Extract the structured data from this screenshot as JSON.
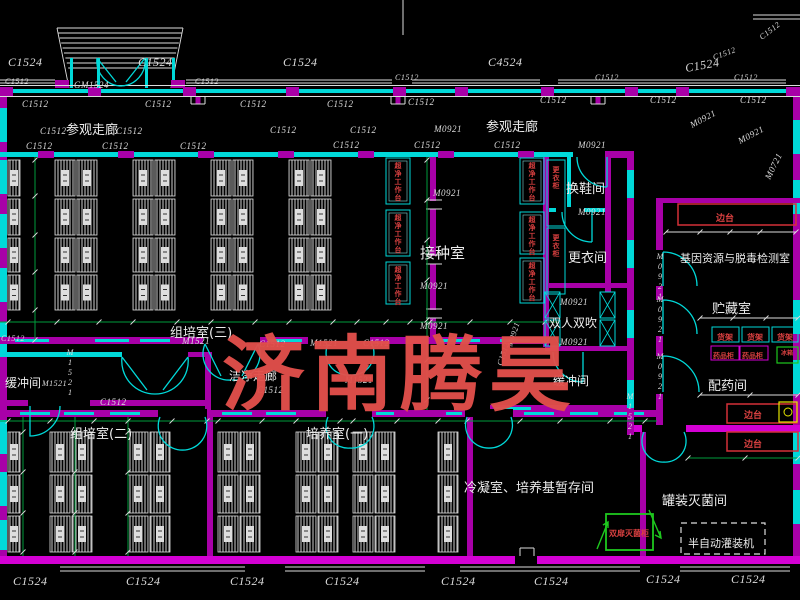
{
  "drawing": {
    "watermark": "济南腾昊",
    "colors": {
      "background": "#000000",
      "wall_cyan": "#00d9d9",
      "wall_magenta": "#a800a8",
      "wall_magenta_bright": "#d400d4",
      "line_white": "#dcdcdc",
      "dim_green": "#009c3c",
      "equip_red": "#d43038",
      "equip_green": "#1ec81e",
      "yellow": "#e6e600",
      "watermark_red": "#e2504b"
    },
    "labels": [
      {
        "t": "C1524",
        "x": 8,
        "y": 66,
        "s": 12,
        "k": "code"
      },
      {
        "t": "C1524",
        "x": 138,
        "y": 66,
        "s": 12,
        "k": "code"
      },
      {
        "t": "C1524",
        "x": 283,
        "y": 66,
        "s": 12,
        "k": "code"
      },
      {
        "t": "C4524",
        "x": 488,
        "y": 66,
        "s": 12,
        "k": "code"
      },
      {
        "t": "C1524",
        "x": 686,
        "y": 72,
        "s": 12,
        "k": "code",
        "r": -10
      },
      {
        "t": "C1512",
        "x": 714,
        "y": 60,
        "s": 8,
        "k": "code",
        "r": -20
      },
      {
        "t": "C1512",
        "x": 762,
        "y": 40,
        "s": 8,
        "k": "code",
        "r": -38
      },
      {
        "t": "GM1524",
        "x": 74,
        "y": 88,
        "s": 9,
        "k": "code"
      },
      {
        "t": "C1512",
        "x": 5,
        "y": 84,
        "s": 8,
        "k": "code"
      },
      {
        "t": "C1512",
        "x": 195,
        "y": 84,
        "s": 8,
        "k": "code"
      },
      {
        "t": "C1512",
        "x": 395,
        "y": 80,
        "s": 8,
        "k": "code"
      },
      {
        "t": "C1512",
        "x": 595,
        "y": 80,
        "s": 8,
        "k": "code"
      },
      {
        "t": "C1512",
        "x": 734,
        "y": 80,
        "s": 8,
        "k": "code"
      },
      {
        "t": "C1512",
        "x": 22,
        "y": 107,
        "s": 9,
        "k": "code"
      },
      {
        "t": "C1512",
        "x": 145,
        "y": 107,
        "s": 9,
        "k": "code"
      },
      {
        "t": "C1512",
        "x": 240,
        "y": 107,
        "s": 9,
        "k": "code"
      },
      {
        "t": "C1512",
        "x": 327,
        "y": 107,
        "s": 9,
        "k": "code"
      },
      {
        "t": "C1512",
        "x": 408,
        "y": 105,
        "s": 9,
        "k": "code"
      },
      {
        "t": "C1512",
        "x": 540,
        "y": 103,
        "s": 9,
        "k": "code"
      },
      {
        "t": "C1512",
        "x": 650,
        "y": 103,
        "s": 9,
        "k": "code"
      },
      {
        "t": "C1512",
        "x": 740,
        "y": 103,
        "s": 9,
        "k": "code"
      },
      {
        "t": "C1512",
        "x": 40,
        "y": 134,
        "s": 9,
        "k": "code"
      },
      {
        "t": "C1512",
        "x": 116,
        "y": 134,
        "s": 9,
        "k": "code"
      },
      {
        "t": "C1512",
        "x": 270,
        "y": 133,
        "s": 9,
        "k": "code"
      },
      {
        "t": "C1512",
        "x": 350,
        "y": 133,
        "s": 9,
        "k": "code"
      },
      {
        "t": "M0921",
        "x": 434,
        "y": 132,
        "s": 9,
        "k": "code"
      },
      {
        "t": "C1512",
        "x": 26,
        "y": 149,
        "s": 9,
        "k": "code"
      },
      {
        "t": "C1512",
        "x": 102,
        "y": 149,
        "s": 9,
        "k": "code"
      },
      {
        "t": "C1512",
        "x": 180,
        "y": 149,
        "s": 9,
        "k": "code"
      },
      {
        "t": "C1512",
        "x": 333,
        "y": 148,
        "s": 9,
        "k": "code"
      },
      {
        "t": "C1512",
        "x": 414,
        "y": 148,
        "s": 9,
        "k": "code"
      },
      {
        "t": "C1512",
        "x": 494,
        "y": 148,
        "s": 9,
        "k": "code"
      },
      {
        "t": "M0921",
        "x": 578,
        "y": 148,
        "s": 9,
        "k": "code"
      },
      {
        "t": "M0921",
        "x": 692,
        "y": 128,
        "s": 9,
        "k": "code",
        "r": -28
      },
      {
        "t": "M0921",
        "x": 740,
        "y": 144,
        "s": 9,
        "k": "code",
        "r": -28
      },
      {
        "t": "M0721",
        "x": 770,
        "y": 180,
        "s": 9,
        "k": "code",
        "r": -64
      },
      {
        "t": "M0921",
        "x": 433,
        "y": 196,
        "s": 9,
        "k": "code"
      },
      {
        "t": "M0921",
        "x": 420,
        "y": 289,
        "s": 9,
        "k": "code"
      },
      {
        "t": "M0921",
        "x": 420,
        "y": 329,
        "s": 9,
        "k": "code"
      },
      {
        "t": "M0921",
        "x": 578,
        "y": 215,
        "s": 9,
        "k": "code"
      },
      {
        "t": "M0921",
        "x": 560,
        "y": 305,
        "s": 9,
        "k": "code"
      },
      {
        "t": "M0921",
        "x": 560,
        "y": 345,
        "s": 9,
        "k": "code"
      },
      {
        "t": "C1512",
        "x": 259,
        "y": 347,
        "s": 9,
        "k": "code"
      },
      {
        "t": "M1521",
        "x": 310,
        "y": 346,
        "s": 9,
        "k": "code"
      },
      {
        "t": "C1512",
        "x": 363,
        "y": 346,
        "s": 9,
        "k": "code"
      },
      {
        "t": "M1521",
        "x": 182,
        "y": 344,
        "s": 9,
        "k": "code"
      },
      {
        "t": "C1512",
        "x": 1,
        "y": 341,
        "s": 8,
        "k": "code"
      },
      {
        "t": "C1512",
        "x": 502,
        "y": 366,
        "s": 8,
        "k": "code",
        "r": -72
      },
      {
        "t": "M0921",
        "x": 512,
        "y": 347,
        "s": 8,
        "k": "code",
        "r": -72
      },
      {
        "t": "M1521",
        "x": 70,
        "y": 348,
        "s": 8,
        "k": "code",
        "v": 1
      },
      {
        "t": "M1521",
        "x": 42,
        "y": 386,
        "s": 8,
        "k": "code"
      },
      {
        "t": "C1512",
        "x": 257,
        "y": 393,
        "s": 9,
        "k": "code"
      },
      {
        "t": "M1521",
        "x": 345,
        "y": 383,
        "s": 9,
        "k": "code"
      },
      {
        "t": "M0921",
        "x": 660,
        "y": 252,
        "s": 8,
        "k": "code",
        "v": 1
      },
      {
        "t": "M0921",
        "x": 660,
        "y": 295,
        "s": 8,
        "k": "code",
        "v": 1
      },
      {
        "t": "M0921",
        "x": 660,
        "y": 352,
        "s": 8,
        "k": "code",
        "v": 1
      },
      {
        "t": "M1521",
        "x": 630,
        "y": 392,
        "s": 8,
        "k": "code",
        "v": 1
      },
      {
        "t": "C1512",
        "x": 100,
        "y": 405,
        "s": 9,
        "k": "code"
      },
      {
        "t": "C1524",
        "x": 13,
        "y": 585,
        "s": 12,
        "k": "code"
      },
      {
        "t": "C1524",
        "x": 126,
        "y": 585,
        "s": 12,
        "k": "code"
      },
      {
        "t": "C1524",
        "x": 230,
        "y": 585,
        "s": 12,
        "k": "code"
      },
      {
        "t": "C1524",
        "x": 325,
        "y": 585,
        "s": 12,
        "k": "code"
      },
      {
        "t": "C1524",
        "x": 441,
        "y": 585,
        "s": 12,
        "k": "code"
      },
      {
        "t": "C1524",
        "x": 534,
        "y": 585,
        "s": 12,
        "k": "code"
      },
      {
        "t": "C1524",
        "x": 646,
        "y": 583,
        "s": 12,
        "k": "code"
      },
      {
        "t": "C1524",
        "x": 731,
        "y": 583,
        "s": 12,
        "k": "code"
      },
      {
        "t": "参观走廊",
        "x": 66,
        "y": 134,
        "s": 13,
        "k": "room"
      },
      {
        "t": "参观走廊",
        "x": 486,
        "y": 131,
        "s": 13,
        "k": "room"
      },
      {
        "t": "换鞋间",
        "x": 566,
        "y": 193,
        "s": 13,
        "k": "room"
      },
      {
        "t": "接种室",
        "x": 420,
        "y": 258,
        "s": 15,
        "k": "room"
      },
      {
        "t": "更衣间",
        "x": 568,
        "y": 262,
        "s": 13,
        "k": "room"
      },
      {
        "t": "双人双吹",
        "x": 549,
        "y": 327,
        "s": 12,
        "k": "room"
      },
      {
        "t": "缓冲间",
        "x": 553,
        "y": 385,
        "s": 12,
        "k": "room"
      },
      {
        "t": "缓冲间",
        "x": 5,
        "y": 387,
        "s": 12,
        "k": "room"
      },
      {
        "t": "组培室(三)",
        "x": 170,
        "y": 337,
        "s": 13,
        "k": "room"
      },
      {
        "t": "洁净走廊",
        "x": 229,
        "y": 380,
        "s": 12,
        "k": "room"
      },
      {
        "t": "组培室(二)",
        "x": 70,
        "y": 438,
        "s": 13,
        "k": "room"
      },
      {
        "t": "培养室(一)",
        "x": 306,
        "y": 438,
        "s": 13,
        "k": "room"
      },
      {
        "t": "冷凝室、培养基暂存间",
        "x": 464,
        "y": 492,
        "s": 13,
        "k": "room"
      },
      {
        "t": "罐装灭菌间",
        "x": 662,
        "y": 505,
        "s": 13,
        "k": "room"
      },
      {
        "t": "基因资源与脱毒检测室",
        "x": 680,
        "y": 262,
        "s": 11,
        "k": "room"
      },
      {
        "t": "贮藏室",
        "x": 712,
        "y": 313,
        "s": 13,
        "k": "room"
      },
      {
        "t": "配药间",
        "x": 708,
        "y": 390,
        "s": 13,
        "k": "room"
      },
      {
        "t": "半自动灌装机",
        "x": 688,
        "y": 547,
        "s": 11,
        "k": "room"
      },
      {
        "t": "边台",
        "x": 716,
        "y": 221,
        "s": 9,
        "k": "equip"
      },
      {
        "t": "边台",
        "x": 744,
        "y": 418,
        "s": 9,
        "k": "equip"
      },
      {
        "t": "边台",
        "x": 744,
        "y": 447,
        "s": 9,
        "k": "equip"
      },
      {
        "t": "货架",
        "x": 717,
        "y": 340,
        "s": 8,
        "k": "equip"
      },
      {
        "t": "货架",
        "x": 747,
        "y": 340,
        "s": 8,
        "k": "equip"
      },
      {
        "t": "货架",
        "x": 777,
        "y": 340,
        "s": 8,
        "k": "equip"
      },
      {
        "t": "药品柜",
        "x": 713,
        "y": 358,
        "s": 7,
        "k": "equip"
      },
      {
        "t": "药品柜",
        "x": 742,
        "y": 358,
        "s": 7,
        "k": "equip"
      },
      {
        "t": "冰箱",
        "x": 781,
        "y": 355,
        "s": 6,
        "k": "equip"
      },
      {
        "t": "双扉灭菌柜",
        "x": 609,
        "y": 536,
        "s": 8,
        "k": "equip"
      },
      {
        "t": "超净工作台",
        "x": 398,
        "y": 162,
        "s": 7,
        "k": "equip",
        "v": 1
      },
      {
        "t": "超净工作台",
        "x": 398,
        "y": 214,
        "s": 7,
        "k": "equip",
        "v": 1
      },
      {
        "t": "超净工作台",
        "x": 398,
        "y": 266,
        "s": 7,
        "k": "equip",
        "v": 1
      },
      {
        "t": "超净工作台",
        "x": 532,
        "y": 162,
        "s": 7,
        "k": "equip",
        "v": 1
      },
      {
        "t": "超净工作台",
        "x": 532,
        "y": 216,
        "s": 7,
        "k": "equip",
        "v": 1
      },
      {
        "t": "超净工作台",
        "x": 532,
        "y": 262,
        "s": 7,
        "k": "equip",
        "v": 1
      },
      {
        "t": "更衣柜",
        "x": 556,
        "y": 166,
        "s": 7,
        "k": "equip",
        "v": 1
      },
      {
        "t": "更衣柜",
        "x": 556,
        "y": 234,
        "s": 7,
        "k": "equip",
        "v": 1
      }
    ]
  }
}
